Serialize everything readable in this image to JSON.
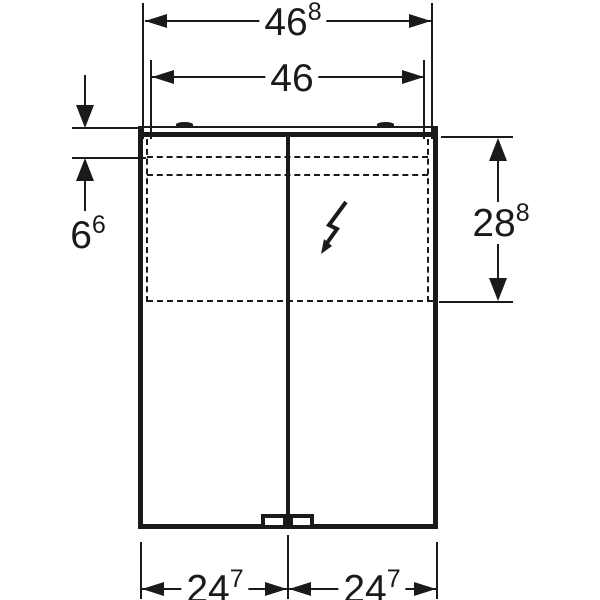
{
  "drawing": {
    "background_color": "#ffffff",
    "line_color": "#1a1a1a",
    "dimensions": {
      "top_outer": {
        "main": "46",
        "sup": "8"
      },
      "top_inner": {
        "main": "46",
        "sup": ""
      },
      "left_offset": {
        "main": "6",
        "sup": "6"
      },
      "right_height": {
        "main": "28",
        "sup": "8"
      },
      "bottom_left": {
        "main": "24",
        "sup": "7"
      },
      "bottom_right": {
        "main": "24",
        "sup": "7"
      }
    },
    "icons": {
      "electrical_connection": "lightning-bolt"
    }
  }
}
